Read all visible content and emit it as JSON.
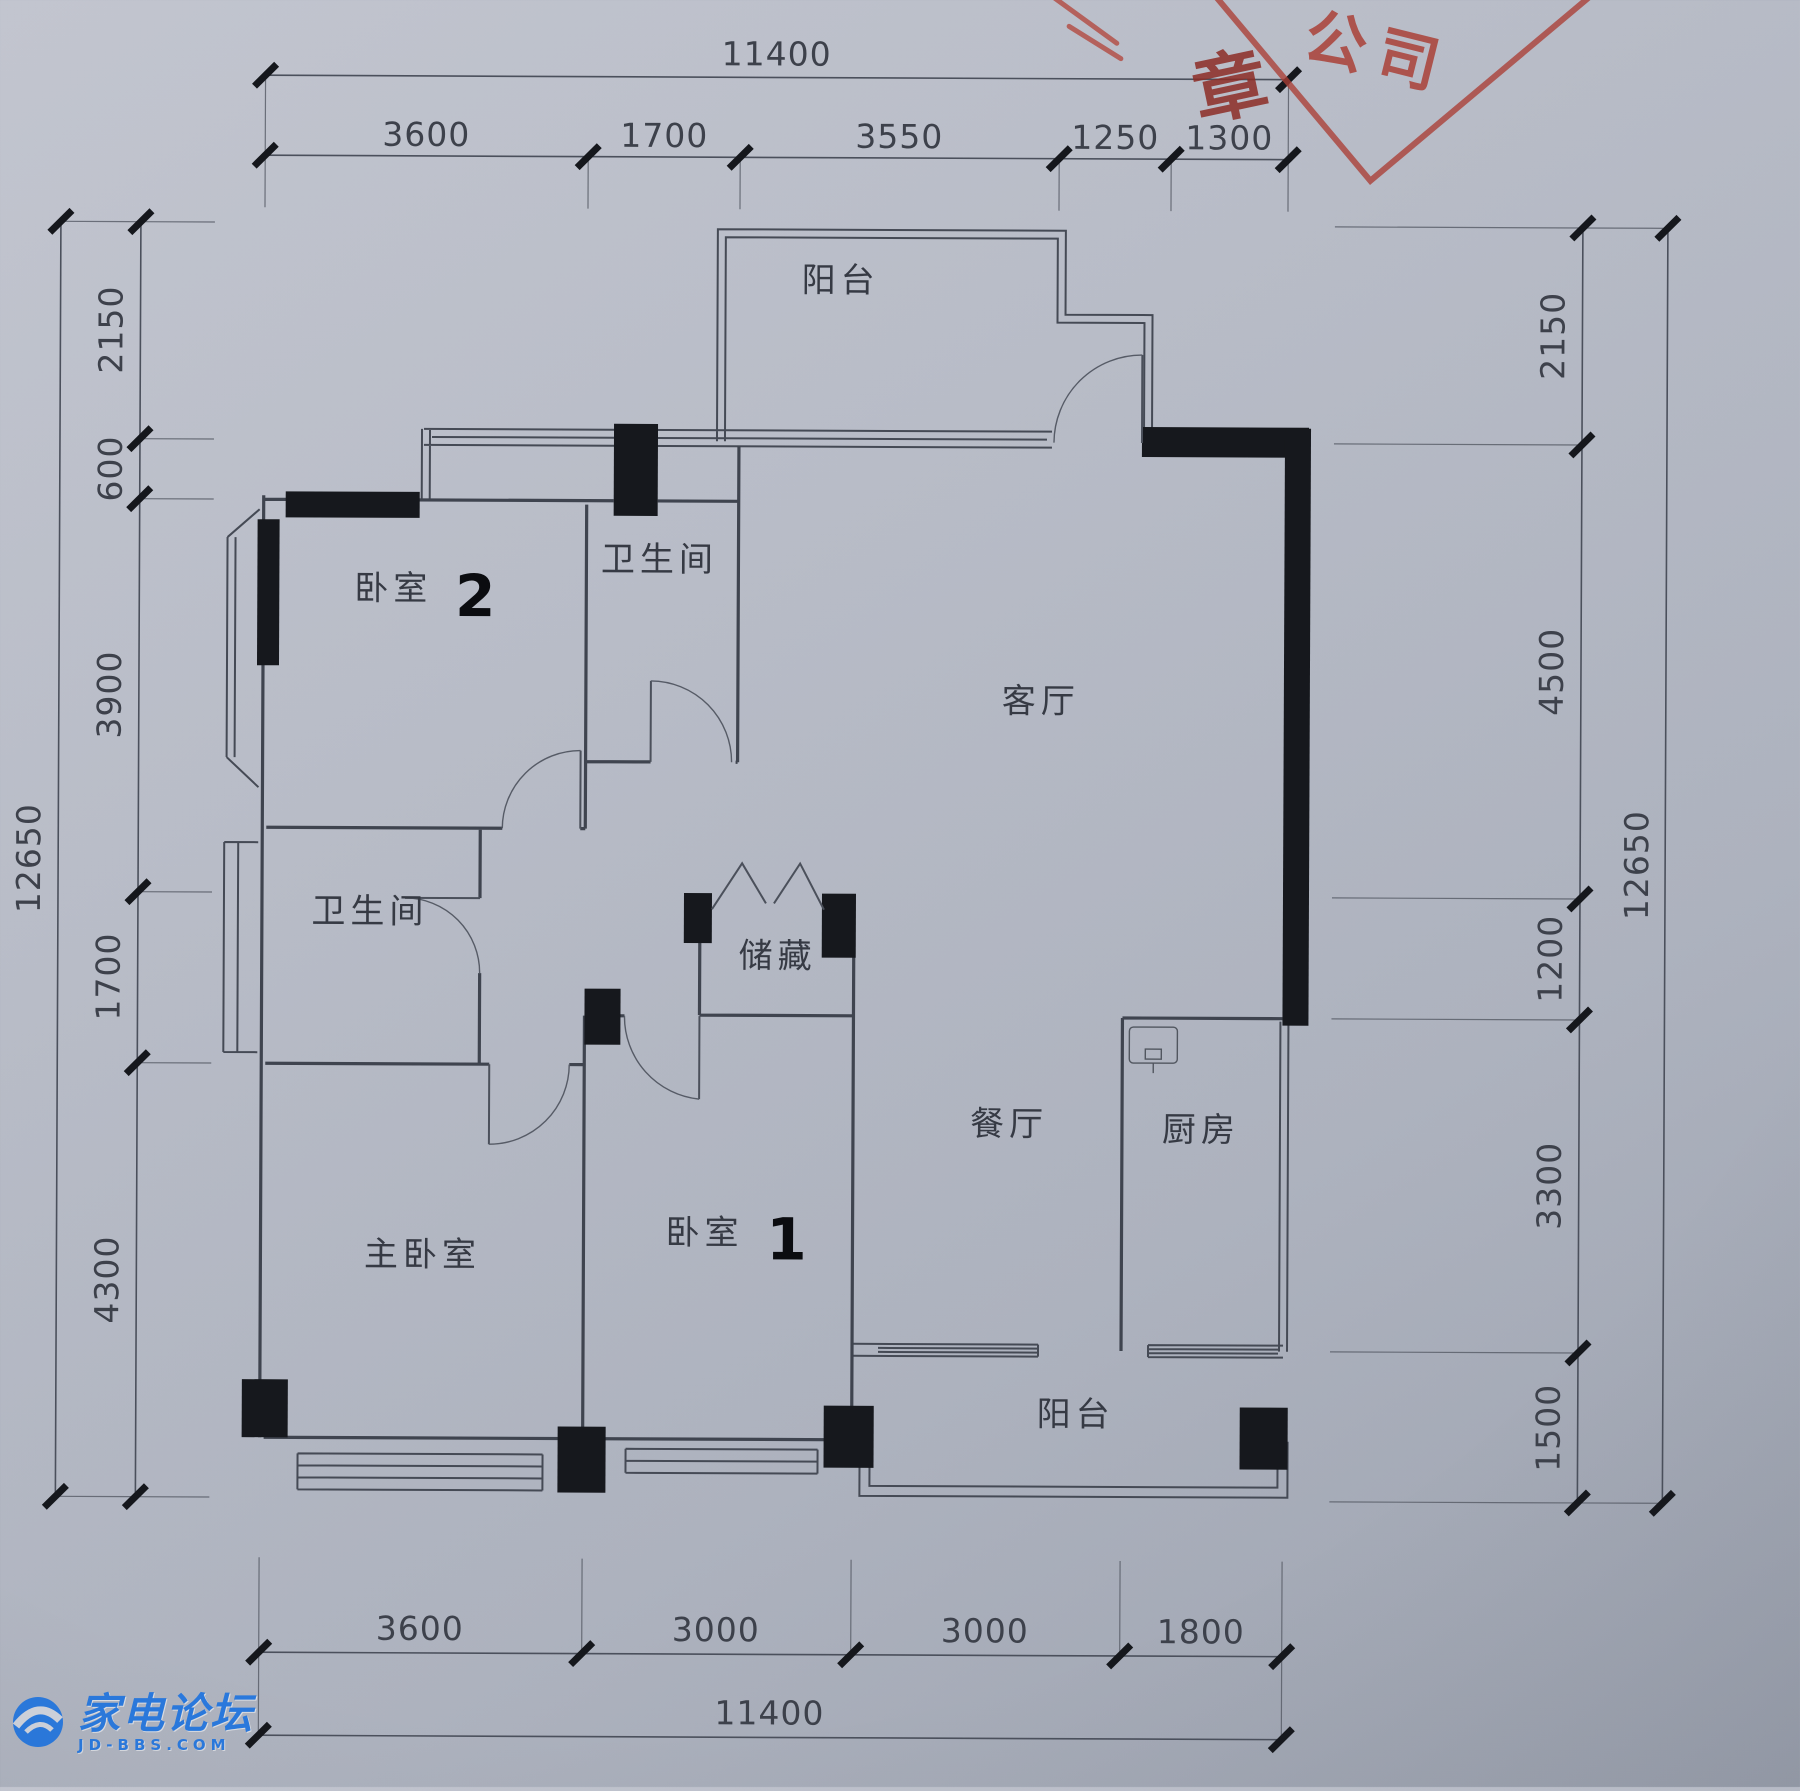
{
  "meta": {
    "kind": "apartment-floor-plan",
    "paper_color": "#b4b8c3",
    "ink_color": "#3f444e"
  },
  "rooms": {
    "balcony_top": "阳台",
    "bedroom2": "卧室",
    "bedroom2_num": "2",
    "bath_upper": "卫生间",
    "living": "客厅",
    "bath_lower": "卫生间",
    "storage": "储藏",
    "dining": "餐厅",
    "kitchen": "厨房",
    "bedroom1": "卧室",
    "bedroom1_num": "1",
    "master": "主卧室",
    "balcony_bottom": "阳台"
  },
  "dims": {
    "top": {
      "total": "11400",
      "segments": [
        "3600",
        "1700",
        "3550",
        "1250",
        "1300"
      ]
    },
    "bottom": {
      "total": "11400",
      "segments": [
        "3600",
        "3000",
        "3000",
        "1800"
      ]
    },
    "left": {
      "total": "12650",
      "segments": [
        "2150",
        "600",
        "3900",
        "1700",
        "4300"
      ]
    },
    "right": {
      "total": "12650",
      "segments": [
        "2150",
        "4500",
        "1200",
        "3300",
        "1500"
      ]
    }
  },
  "stamp": {
    "company": "公司",
    "seal": "章",
    "color": "#ab3e34"
  },
  "watermark": {
    "title": "家电论坛",
    "site": "JD-BBS.COM",
    "color": "#2a79dd"
  }
}
